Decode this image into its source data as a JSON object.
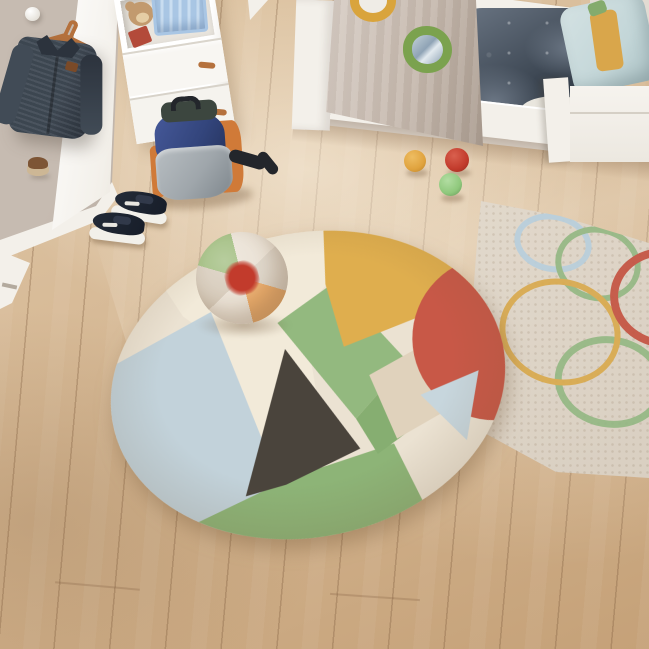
{
  "scene": {
    "description": "Top-down view of a children's bedroom: round patchwork cotton rug with plush beach ball, beige rug with colored circle outlines, white toddler bed with taupe canopy portholes and dark blue bedding, white dresser with toy crate and teddy, jacket on wall hook, backpack, sneakers and felt pom-pom balls on light oak floor",
    "objects": [
      {
        "name": "round-patchwork-rug",
        "patches": [
          "pale-blue",
          "cream",
          "charcoal",
          "green",
          "mustard",
          "terracotta-red",
          "beige"
        ]
      },
      {
        "name": "beach-ball-plush",
        "segments": [
          "green",
          "cream",
          "beige",
          "orange"
        ],
        "center": "red-pompom"
      },
      {
        "name": "circles-rug",
        "circle_colors": [
          "light-blue",
          "green",
          "yellow",
          "red"
        ]
      },
      {
        "name": "toddler-bed",
        "bedding": "dark-slate-blue",
        "pillow": "light-blue-with-mustard-stripe"
      },
      {
        "name": "canopy-panel",
        "portholes": [
          "yellow-ring",
          "green-ring-mirror"
        ]
      },
      {
        "name": "dresser",
        "contents": [
          "teddy-bear",
          "blue-crate",
          "red-books"
        ]
      },
      {
        "name": "denim-jacket-on-hanger"
      },
      {
        "name": "hedgehog-plush-on-wall"
      },
      {
        "name": "wall-hook-knob"
      },
      {
        "name": "backpack",
        "colors": [
          "navy",
          "gray",
          "orange",
          "dark-green"
        ]
      },
      {
        "name": "sneakers-pair",
        "color": "navy-white-sole"
      },
      {
        "name": "pom-pom-balls",
        "colors": [
          "orange",
          "red",
          "green"
        ]
      }
    ]
  },
  "colors": {
    "floor-light": "#e0c8a8",
    "floor-mid": "#d5b793",
    "floor-dark": "#c5a178",
    "wall": "#c6bbb1",
    "wall-dark": "#b4a99f",
    "wall-light": "#e2dbd2",
    "white-wood": "#f3f0ea",
    "hanger": "#b5713d",
    "jacket": "#414b56",
    "jacket-dark": "#2c333d",
    "patch": "#7a4a28",
    "hedgehog-brown": "#7d5535",
    "hedgehog-tan": "#cdb795",
    "teddy": "#c29a6e",
    "book-red": "#b34a3a",
    "crate": "#a9c6e4",
    "duvet": "#3a4450",
    "duvet-light": "#6b7684",
    "duvet-dark": "#262e38",
    "pillow": "#c3d6d8",
    "pillow-stripe": "#d9a64b",
    "pillow-green": "#84ab6d",
    "canopy": "#c6b9ae",
    "canopy-dark": "#aa9c90",
    "ring-yellow": "#d9a43c",
    "ring-green": "#7ba24e",
    "mirror": "#8fa3b5",
    "rug2-base": "#d8cec0",
    "circle-blue": "#b8cfdd",
    "circle-green": "#93b883",
    "circle-yellow": "#d9a94c",
    "circle-red": "#c4513f",
    "rug-cream": "#ebe2d2",
    "rug-cream2": "#f2ead9",
    "rug-blue": "#c2d2da",
    "rug-blue2": "#c7d6dd",
    "rug-green": "#93b97f",
    "rug-green2": "#86ae71",
    "rug-green3": "#8db477",
    "rug-charcoal": "#4a443c",
    "rug-beige": "#e0d2bc",
    "rug-yellow": "#dfae4e",
    "rug-red": "#c85847",
    "ball-green": "#9cba79",
    "ball-cream": "#e9e0d3",
    "ball-beige": "#dcd3c6",
    "ball-beige2": "#d5c9b8",
    "ball-orange": "#e8aa6a",
    "pom-red": "#c23b2c",
    "pom-orange": "#e0a33e",
    "pom-green": "#8fc87c",
    "pack-navy": "#33457c",
    "pack-green": "#3c463f",
    "pack-orange": "#d07a38",
    "pack-gray": "#9fa6ab",
    "pack-black": "#23262b",
    "shoe-navy": "#232b38"
  }
}
